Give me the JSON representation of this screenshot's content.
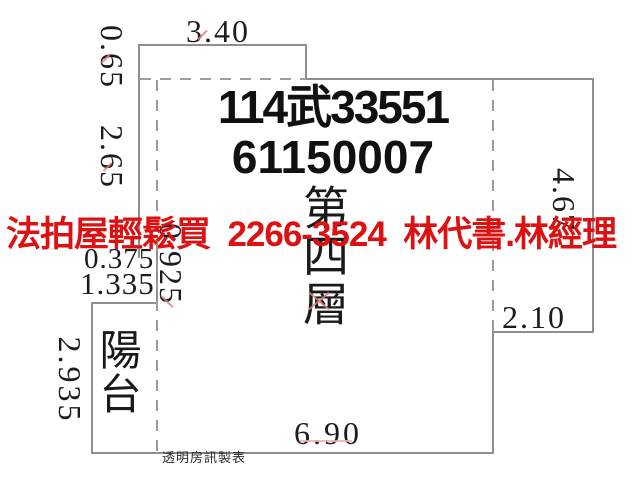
{
  "watermark": {
    "text": "法拍屋輕鬆買  2266-3524  林代書.林經理",
    "color": "#dd1111"
  },
  "case_number": {
    "line1": "114武33551",
    "line2": "61150007"
  },
  "labels": {
    "floor": "第四層",
    "balcony": "陽台",
    "credit": "透明房訊製表"
  },
  "dimensions": {
    "top_width": "3.40",
    "left_upper": "0.65",
    "left_middle": "2.65",
    "right_height": "4.67",
    "right_step_width": "2.10",
    "bottom_width": "6.90",
    "inset_width": "0.375",
    "balcony_width": "1.335",
    "left_wall_segment": "0.925",
    "balcony_height": "2.935"
  },
  "colors": {
    "wall_line": "#8f8f8f",
    "dashed_line": "#9e9a9a",
    "dimension_text": "#1c1c1c",
    "watermark_red": "#dd1111",
    "tick_red": "#e07b7b",
    "background": "#ffffff"
  }
}
